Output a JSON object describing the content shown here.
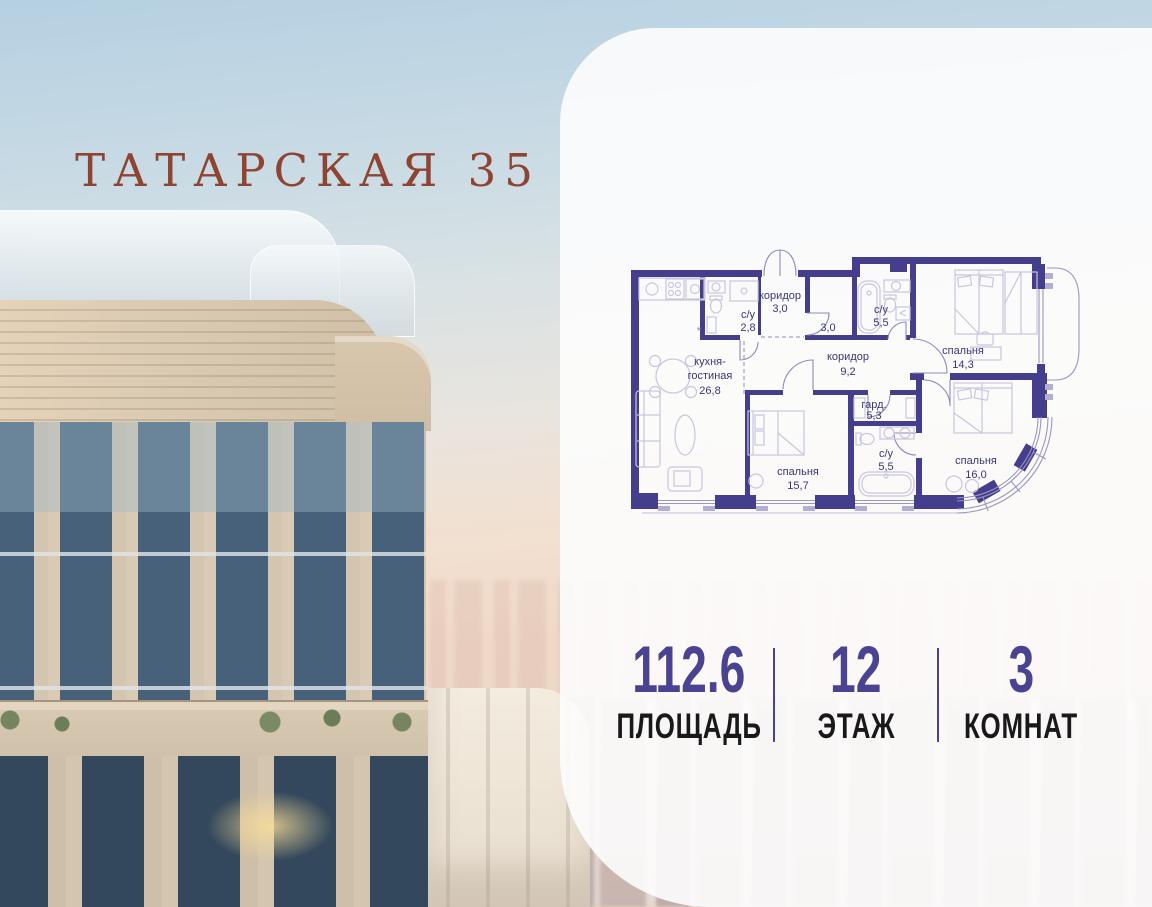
{
  "project": {
    "title": "ТАТАРСКАЯ 35"
  },
  "stats": {
    "area": {
      "value": "112.6",
      "label": "ПЛОЩАДЬ"
    },
    "floor": {
      "value": "12",
      "label": "ЭТАЖ"
    },
    "rooms": {
      "value": "3",
      "label": "КОМНАТ"
    }
  },
  "floor_plan": {
    "rooms": [
      {
        "id": "entry-corridor",
        "name": "коридор",
        "area": "3,0"
      },
      {
        "id": "bathroom-1",
        "name": "с/у",
        "area": "2,8"
      },
      {
        "id": "storage",
        "name": "",
        "area": "3,0"
      },
      {
        "id": "bathroom-2",
        "name": "с/у",
        "area": "5,5"
      },
      {
        "id": "bedroom-1",
        "name": "спальня",
        "area": "14,3"
      },
      {
        "id": "corridor",
        "name": "коридор",
        "area": "9,2"
      },
      {
        "id": "kitchen-living",
        "name": "кухня-",
        "name2": "гостиная",
        "area": "26,8"
      },
      {
        "id": "wardrobe",
        "name": "гард.",
        "area": "5,3"
      },
      {
        "id": "bedroom-2",
        "name": "спальня",
        "area": "15,7"
      },
      {
        "id": "bathroom-3",
        "name": "с/у",
        "area": "5,5"
      },
      {
        "id": "bedroom-3",
        "name": "спальня",
        "area": "16,0"
      }
    ]
  },
  "colors": {
    "accent_purple": "#4a4391",
    "plan_wall": "#443e8c",
    "title_red": "#8e4433"
  }
}
